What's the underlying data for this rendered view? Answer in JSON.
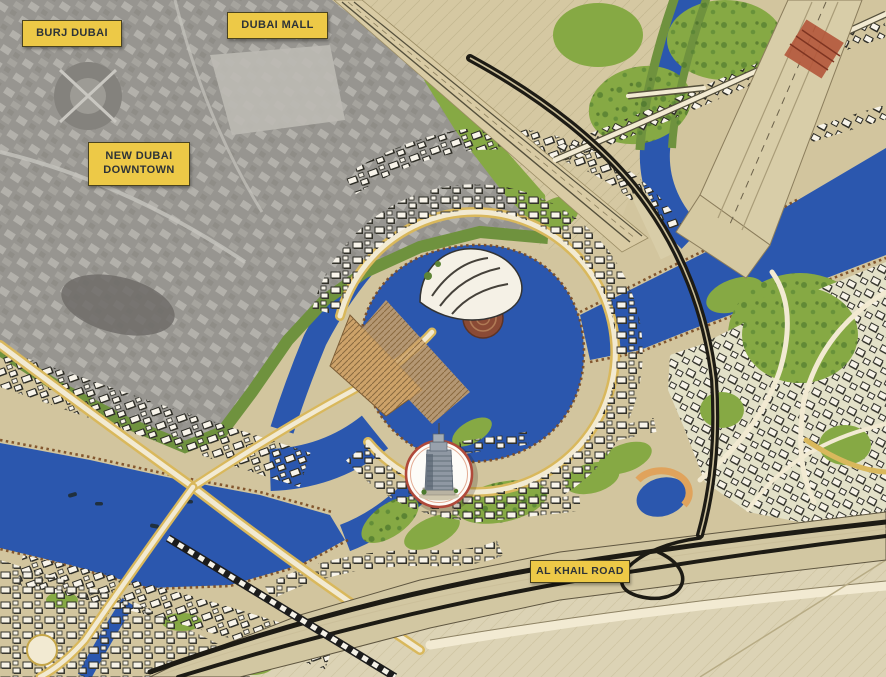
{
  "map": {
    "type": "master-plan-location-map",
    "labels": {
      "burj_dubai": "BURJ DUBAI",
      "dubai_mall": "DUBAI MALL",
      "new_dubai_downtown": "NEW DUBAI DOWNTOWN",
      "al_khail_road": "AL KHAIL ROAD"
    },
    "marker": {
      "name": "project-tower-location",
      "shape": "circle-with-tower-photo"
    },
    "colors": {
      "water": "#2b57ae",
      "land": "#d2c59e",
      "desert": "#dcd3b5",
      "photo_grey": "#979590",
      "green": "#86a944",
      "road_gold": "#d9b85c",
      "road_cream": "#f2ead2",
      "highway_dark": "#1d1b14",
      "label_bg": "#edc947",
      "label_border": "#4a431f",
      "label_text": "#2e3338",
      "marker_ring": "#b0493a",
      "building_white": "#f8f4ea"
    }
  }
}
